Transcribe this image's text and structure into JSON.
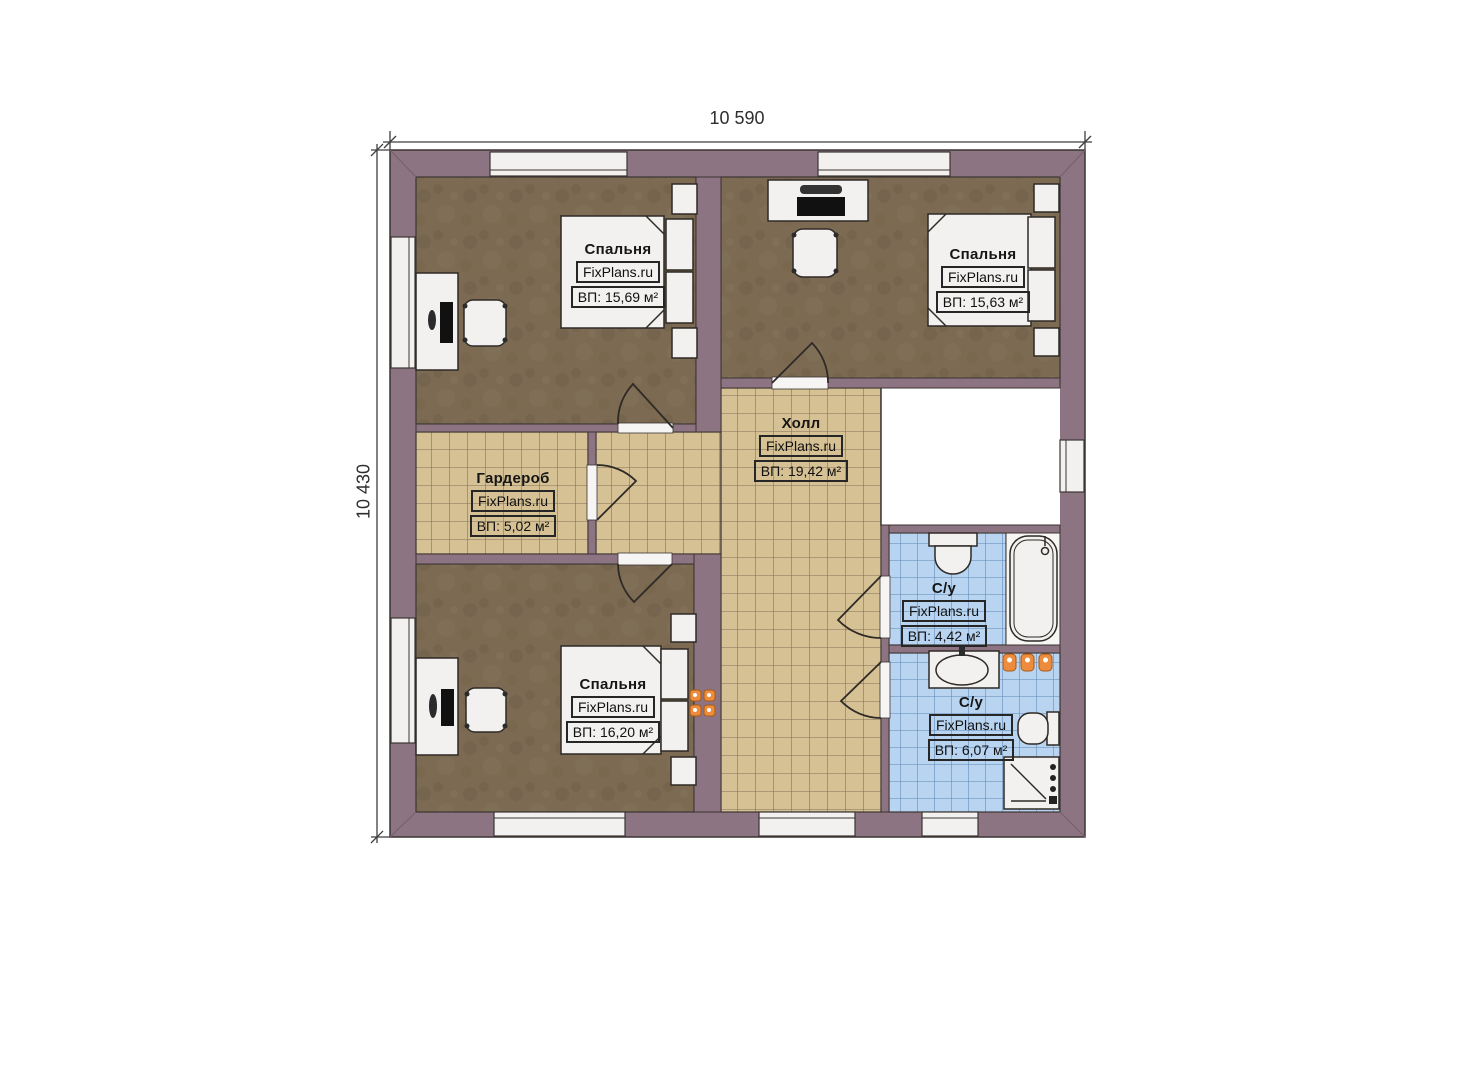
{
  "watermark": "FixPlans.ru",
  "dimensions": {
    "width": "10 590",
    "height": "10 430"
  },
  "rooms": [
    {
      "id": "bedroom-top-left",
      "name": "Спальня",
      "area": "ВП: 15,69 м²"
    },
    {
      "id": "bedroom-top-right",
      "name": "Спальня",
      "area": "ВП: 15,63 м²"
    },
    {
      "id": "hall",
      "name": "Холл",
      "area": "ВП: 19,42 м²"
    },
    {
      "id": "wardrobe",
      "name": "Гардероб",
      "area": "ВП: 5,02 м²"
    },
    {
      "id": "bedroom-bottom-left",
      "name": "Спальня",
      "area": "ВП: 16,20 м²"
    },
    {
      "id": "bathroom-top",
      "name": "С/у",
      "area": "ВП: 4,42 м²"
    },
    {
      "id": "bathroom-bottom",
      "name": "С/у",
      "area": "ВП: 6,07 м²"
    }
  ],
  "colors": {
    "wall": "#8d7482",
    "bedroom_floor": "#7c6a52",
    "tile_floor": "#d6c194",
    "bathroom_tile": "#b8d4f0",
    "fixture_white": "#f2f1ef",
    "radiator_orange": "#ee8c3e"
  }
}
